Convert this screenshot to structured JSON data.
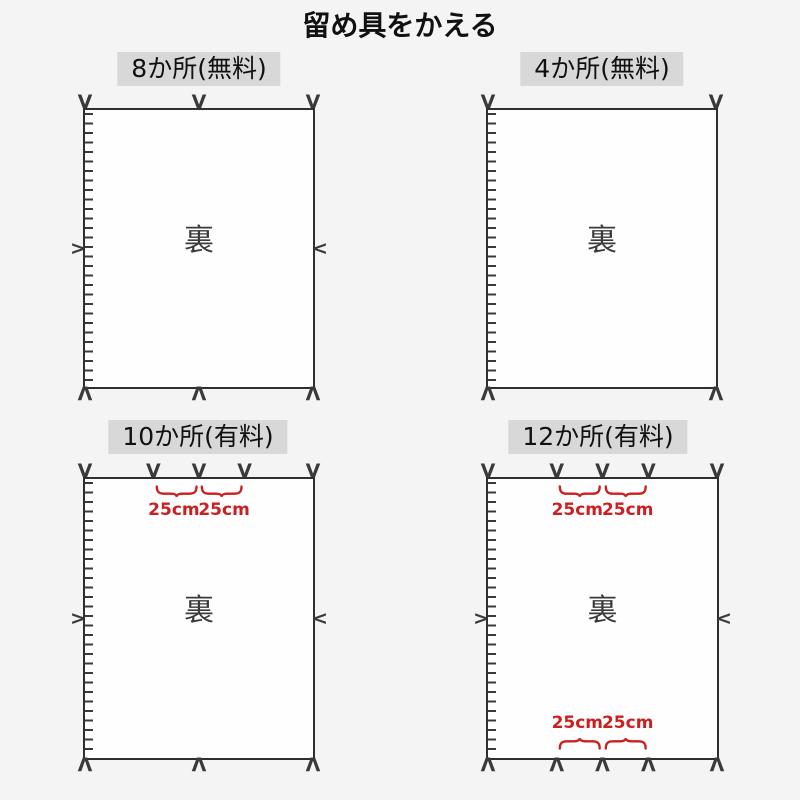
{
  "title": "留め具をかえる",
  "back_label": "裏",
  "measure_label": "25cm",
  "icons": {
    "mark_down": "V",
    "mark_up": "Λ",
    "mark_right": ">",
    "mark_left": "<"
  },
  "panels": [
    {
      "label": "8か所(無料)"
    },
    {
      "label": "4か所(無料)"
    },
    {
      "label": "10か所(有料)",
      "top_braces": [
        "25cm",
        "25cm"
      ]
    },
    {
      "label": "12か所(有料)",
      "top_braces": [
        "25cm",
        "25cm"
      ],
      "bottom_braces": [
        "25cm",
        "25cm"
      ]
    }
  ],
  "colors": {
    "page_bg": "#f4f4f4",
    "sheet_bg": "#fefefe",
    "line": "#2f2f2f",
    "mark": "#3a3a3a",
    "label_bg": "#d8d8d8",
    "text": "#111111",
    "accent_red": "#cc1f1f"
  }
}
